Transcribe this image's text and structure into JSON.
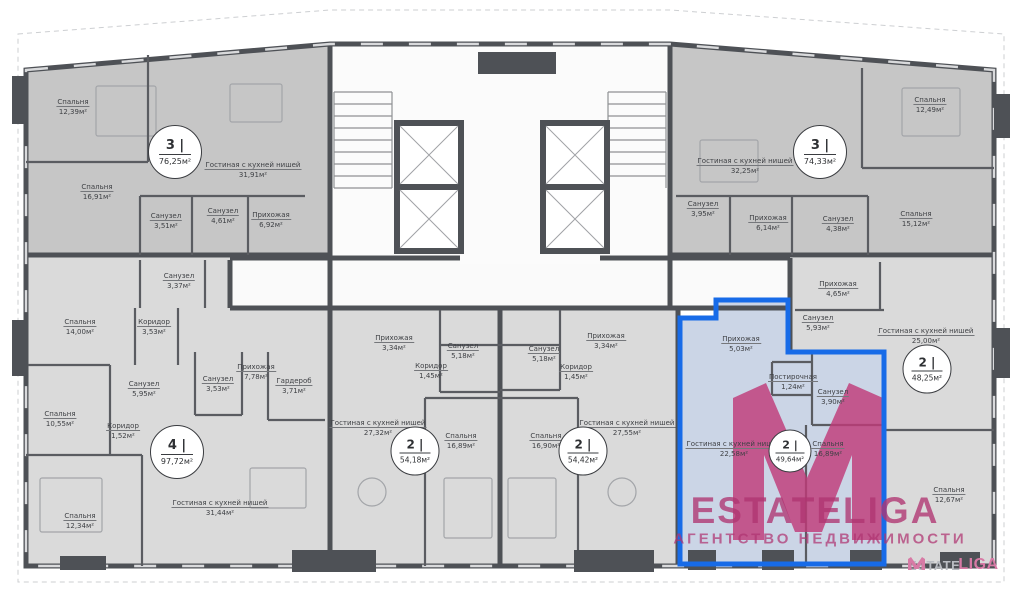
{
  "watermark": {
    "brand": "ESTATELIGA",
    "subtitle": "АГЕНТСТВО НЕДВИЖИМОСТИ"
  },
  "footer_logo": {
    "estate": "ESTATE",
    "liga": "LIGA"
  },
  "colors": {
    "highlight_border": "#176be8",
    "highlight_fill": "#cbd5e6",
    "brand_pink": "#c03a79",
    "apartment_dark_fill": "#c6c6c6",
    "apartment_light_fill": "#dadada",
    "walls": "#4e5156"
  },
  "apartments": [
    {
      "id": "top-left-3room",
      "num": "3 |",
      "area": "76,25м²",
      "rooms": [
        {
          "name": "Спальня",
          "area": "12,39м²"
        },
        {
          "name": "Спальня",
          "area": "16,91м²"
        },
        {
          "name": "Гостиная с кухней нишей",
          "area": "31,91м²"
        },
        {
          "name": "Санузел",
          "area": "3,51м²"
        },
        {
          "name": "Санузел",
          "area": "4,61м²"
        },
        {
          "name": "Прихожая",
          "area": "6,92м²"
        }
      ]
    },
    {
      "id": "top-right-3room",
      "num": "3 |",
      "area": "74,33м²",
      "rooms": [
        {
          "name": "Гостиная с кухней нишей",
          "area": "32,25м²"
        },
        {
          "name": "Спальня",
          "area": "12,49м²"
        },
        {
          "name": "Санузел",
          "area": "3,95м²"
        },
        {
          "name": "Прихожая",
          "area": "6,14м²"
        },
        {
          "name": "Санузел",
          "area": "4,38м²"
        },
        {
          "name": "Спальня",
          "area": "15,12м²"
        }
      ]
    },
    {
      "id": "left-4room",
      "num": "4 |",
      "area": "97,72м²",
      "rooms": [
        {
          "name": "Санузел",
          "area": "3,37м²"
        },
        {
          "name": "Спальня",
          "area": "14,00м²"
        },
        {
          "name": "Коридор",
          "area": "3,53м²"
        },
        {
          "name": "Санузел",
          "area": "5,95м²"
        },
        {
          "name": "Санузел",
          "area": "3,53м²"
        },
        {
          "name": "Прихожая",
          "area": "7,78м²"
        },
        {
          "name": "Гардероб",
          "area": "3,71м²"
        },
        {
          "name": "Спальня",
          "area": "10,55м²"
        },
        {
          "name": "Коридор",
          "area": "1,52м²"
        },
        {
          "name": "Спальня",
          "area": "12,34м²"
        },
        {
          "name": "Гостиная с кухней нишей",
          "area": "31,44м²"
        }
      ]
    },
    {
      "id": "middle-2room-a",
      "num": "2 |",
      "area": "54,18м²",
      "rooms": [
        {
          "name": "Прихожая",
          "area": "3,34м²"
        },
        {
          "name": "Санузел",
          "area": "5,18м²"
        },
        {
          "name": "Коридор",
          "area": "1,45м²"
        },
        {
          "name": "Гостиная с кухней нишей",
          "area": "27,32м²"
        },
        {
          "name": "Спальня",
          "area": "16,89м²"
        }
      ]
    },
    {
      "id": "middle-2room-b",
      "num": "2 |",
      "area": "54,42м²",
      "rooms": [
        {
          "name": "Прихожая",
          "area": "3,34м²"
        },
        {
          "name": "Санузел",
          "area": "5,18м²"
        },
        {
          "name": "Коридор",
          "area": "1,45м²"
        },
        {
          "name": "Спальня",
          "area": "16,90м²"
        },
        {
          "name": "Гостиная с кухней нишей",
          "area": "27,55м²"
        }
      ]
    },
    {
      "id": "highlighted-2room",
      "num": "2 |",
      "area": "49,64м²",
      "rooms": [
        {
          "name": "Прихожая",
          "area": "5,03м²"
        },
        {
          "name": "Постирочная",
          "area": "1,24м²"
        },
        {
          "name": "Санузел",
          "area": "3,90м²"
        },
        {
          "name": "Гостиная с кухней нишей",
          "area": "22,58м²"
        },
        {
          "name": "Спальня",
          "area": "16,89м²"
        }
      ]
    },
    {
      "id": "right-2room",
      "num": "2 |",
      "area": "48,25м²",
      "rooms": [
        {
          "name": "Прихожая",
          "area": "4,65м²"
        },
        {
          "name": "Санузел",
          "area": "5,93м²"
        },
        {
          "name": "Гостиная с кухней нишей",
          "area": "25,00м²"
        },
        {
          "name": "Спальня",
          "area": "12,67м²"
        }
      ]
    }
  ]
}
